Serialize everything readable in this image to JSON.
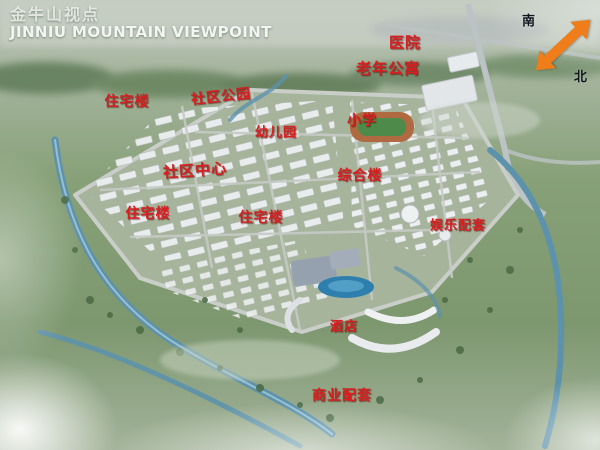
{
  "title": {
    "zh": "金牛山视点",
    "en": "JINNIU MOUNTAIN VIEWPOINT"
  },
  "compass": {
    "south": "南",
    "north": "北",
    "arrow_color": "#ee7d1a"
  },
  "colors": {
    "label_red": "#d61f1f",
    "title_white": "#f2f5f1",
    "water_blue": "#5d92ac",
    "site_green": "#a7b49c"
  },
  "map": {
    "labels": [
      {
        "text": "医院",
        "name": "hospital",
        "x": 405,
        "y": 42,
        "size": 15,
        "rot": 0
      },
      {
        "text": "老年公寓",
        "name": "senior-apartments",
        "x": 388,
        "y": 68,
        "size": 15,
        "rot": 0
      },
      {
        "text": "住宅楼",
        "name": "residential-building-1",
        "x": 127,
        "y": 101,
        "size": 14,
        "rot": 0
      },
      {
        "text": "社区公园",
        "name": "community-park",
        "x": 221,
        "y": 96,
        "size": 14,
        "rot": -6
      },
      {
        "text": "小学",
        "name": "primary-school",
        "x": 362,
        "y": 120,
        "size": 14,
        "rot": 0
      },
      {
        "text": "幼儿园",
        "name": "kindergarten",
        "x": 276,
        "y": 131,
        "size": 13,
        "rot": 0
      },
      {
        "text": "社区中心",
        "name": "community-center",
        "x": 195,
        "y": 170,
        "size": 15,
        "rot": -4
      },
      {
        "text": "综合楼",
        "name": "complex-building",
        "x": 360,
        "y": 175,
        "size": 14,
        "rot": 0
      },
      {
        "text": "住宅楼",
        "name": "residential-building-2",
        "x": 148,
        "y": 213,
        "size": 14,
        "rot": 0
      },
      {
        "text": "住宅楼",
        "name": "residential-building-3",
        "x": 261,
        "y": 217,
        "size": 14,
        "rot": 0
      },
      {
        "text": "娱乐配套",
        "name": "entertainment-facilities",
        "x": 458,
        "y": 224,
        "size": 13,
        "rot": 0
      },
      {
        "text": "酒店",
        "name": "hotel",
        "x": 344,
        "y": 325,
        "size": 13,
        "rot": 0
      },
      {
        "text": "商业配套",
        "name": "commercial-facilities",
        "x": 342,
        "y": 395,
        "size": 14,
        "rot": 0
      }
    ]
  }
}
